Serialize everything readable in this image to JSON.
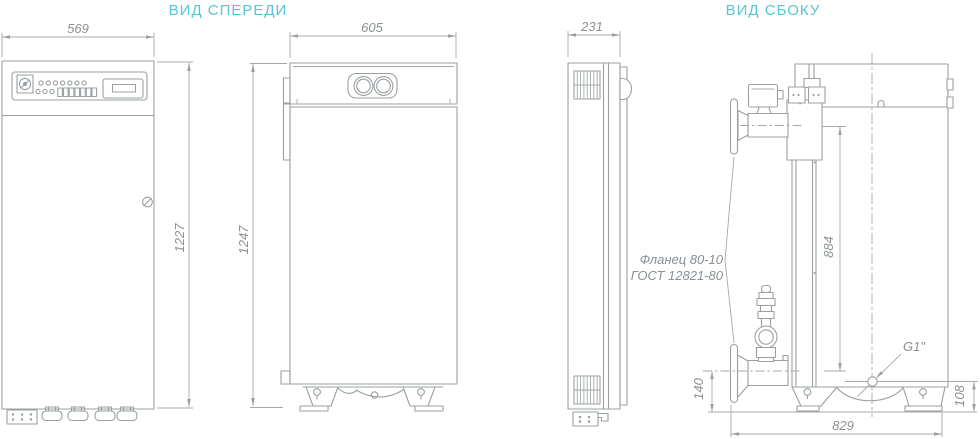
{
  "titles": {
    "front": "ВИД СПЕРЕДИ",
    "side": "ВИД СБОКУ"
  },
  "dimensions": {
    "cabinet_width_mm": "569",
    "boiler_width_mm": "605",
    "cabinet_depth_mm": "231",
    "cabinet_height_mm": "1227",
    "boiler_height_mm": "1247",
    "pipe_centers_mm": "884",
    "inlet_axis_height_mm": "140",
    "drain_height_mm": "108",
    "boiler_depth_mm": "829"
  },
  "annotations": {
    "flange_label_line1": "Фланец 80-10",
    "flange_label_line2": "ГОСТ 12821-80",
    "drain_connection": "G1\""
  },
  "colors": {
    "accent_title": "#57c6d4",
    "drawing_line": "#9aa0a3",
    "dim_text": "#8a9094"
  }
}
